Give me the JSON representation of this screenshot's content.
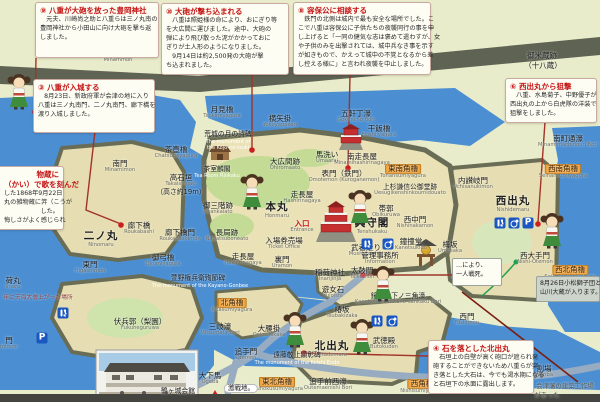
{
  "sign": {
    "background": "#e9ecca",
    "accent_red": "#c41414",
    "moat_blue": "#4b8fd2",
    "wall_olive": "#6a6d55"
  },
  "annotation_boxes": [
    {
      "title": "⑨ 八重が大砲を放った豊岡神社",
      "lines": [
        "　元夫、川崎尚之助と八重らは三ノ丸南の",
        "豊岡神社から小田山に向け大砲を撃ち返",
        "しました。"
      ],
      "x": 35,
      "y": 2,
      "w": 124,
      "h": 56
    },
    {
      "title": "⑩ 大砲が撃ち込まれる",
      "lines": [
        "　八重は照姫様の命により、おにぎり等",
        "を大広間に運びました。途中、大砲の",
        "弾により飛び散った泥がかかっておに",
        "ぎりが土人形のようになりました。",
        "　9月14日は約2,500発の大砲が撃",
        "ち込まれました。"
      ],
      "x": 161,
      "y": 3,
      "w": 128,
      "h": 61
    },
    {
      "title": "⑧ 容保公に相談する",
      "lines": [
        "　鉄門の北側は城内で最も安全な場所でした。こ",
        "こで八重は容保公に子供たちの夜襲同行の事を申",
        "し上げると「一同の健気な志は褒めて遣わすが、女",
        "や子供のみを出撃されては、城中兵なき事を示す",
        "が如きもので、かえって城中の不覚となるから差",
        "し控える様に」と言われ夜襲を中止しました。"
      ],
      "x": 293,
      "y": 2,
      "w": 138,
      "h": 73
    },
    {
      "title": "③ 八重が入城する",
      "lines": [
        "　8月23日、新政府軍が会津の地に入り",
        "八重は三ノ丸南門、二ノ丸南門、廊下橋を",
        "渡り入城しました。"
      ],
      "x": 33,
      "y": 79,
      "w": 122,
      "h": 54
    },
    {
      "title": "⑥ 西出丸から狙撃",
      "lines": [
        "　八重、水島菊子、中野優子が",
        "西出丸の上から白虎隊の洋装で",
        "狙撃をしました。"
      ],
      "x": 505,
      "y": 78,
      "w": 92,
      "h": 44
    },
    {
      "title": "④ 石を落とした北出丸",
      "lines": [
        "　石垣上の白壁が高く砲口が遮られ発",
        "砲することができないため八重らが突",
        "き落とした大石は、今でも渇水期になる",
        "と石垣下の水面に露出します。"
      ],
      "x": 428,
      "y": 340,
      "w": 106,
      "h": 53
    }
  ],
  "cut_box": {
    "title_lines": [
      "物蔵に",
      "（かい）で歌を刻んだ"
    ],
    "lines": [
      "した1868年9月22日",
      "丸の雑物蔵に笄（こうが",
      "した。",
      "悔しさがよく感じられ"
    ],
    "x": 0,
    "y": 166,
    "w": 64,
    "h": 64
  },
  "notes": [
    {
      "lines": [
        "8月26日小松獅子団と",
        "山川大蔵が入ります。"
      ],
      "x": 536,
      "y": 276,
      "w": 64,
      "h": 26,
      "bg": "#cdd4cb"
    },
    {
      "lines": [
        "…により、",
        "一人戦死。"
      ],
      "x": 452,
      "y": 258,
      "w": 50,
      "h": 28,
      "bg": "#fdfdf4"
    }
  ],
  "map": {
    "labels": [
      {
        "t": "南門",
        "r": "Minammon",
        "x": 118,
        "y": 50
      },
      {
        "t": "南門",
        "r": "Minamimon",
        "x": 120,
        "y": 160
      },
      {
        "t": "月見櫓",
        "r": "Tsukimiyagura",
        "x": 222,
        "y": 106
      },
      {
        "t": "横矢掛",
        "r": "Yokoyagakari",
        "x": 280,
        "y": 115
      },
      {
        "t": "五軒丁濠",
        "r": "Gokencho Bori",
        "x": 356,
        "y": 110
      },
      {
        "t": "干飯櫓",
        "r": "Hoshiiyagura",
        "x": 379,
        "y": 125
      },
      {
        "t": "茶壺櫓",
        "r": "Chatsubayagura",
        "x": 176,
        "y": 146
      },
      {
        "t": "高石垣",
        "r": "Takaishigaki",
        "x": 181,
        "y": 174
      },
      {
        "t": "（高さ約19m）",
        "x": 181,
        "y": 189,
        "s": "small"
      },
      {
        "t": "御米蔵跡",
        "x": 542,
        "y": 52
      },
      {
        "t": "（十八蔵）",
        "x": 543,
        "y": 62
      },
      {
        "t": "南町通濠",
        "r": "Minamimachidouri Bori",
        "x": 568,
        "y": 135
      },
      {
        "t": "西南角櫓",
        "r": "Seinansumiyagura",
        "x": 563,
        "y": 164,
        "s": "chip-orange"
      },
      {
        "t": "東南角櫓",
        "r": "Tonansumiyagura",
        "x": 403,
        "y": 164,
        "s": "chip-orange"
      },
      {
        "t": "内讃岐門",
        "r": "Uchisanukimon",
        "x": 473,
        "y": 177
      },
      {
        "t": "上杉謙信公御堂跡",
        "r": "Uesugikenshinkoumidouato",
        "x": 410,
        "y": 184,
        "s": "small"
      },
      {
        "t": "西出丸",
        "r": "Nishidemaru",
        "x": 513,
        "y": 196,
        "s": "bold"
      },
      {
        "t": "西中門",
        "r": "Nishinakamon",
        "x": 415,
        "y": 216
      },
      {
        "t": "梅坂",
        "r": "Umesaka",
        "x": 450,
        "y": 241
      },
      {
        "t": "鐘撞堂",
        "r": "Kanetsukido",
        "x": 411,
        "y": 238
      },
      {
        "t": "西大手門",
        "r": "Nishi-Otemon",
        "x": 535,
        "y": 252
      },
      {
        "t": "西北角櫓",
        "r": "Seihokusumiyagura",
        "x": 570,
        "y": 265,
        "s": "chip-orange"
      },
      {
        "t": "荒城の月の詩碑",
        "x": 228,
        "y": 131,
        "s": "small"
      },
      {
        "t": "The monument of",
        "x": 228,
        "y": 140,
        "s": "en-white"
      },
      {
        "t": "the Kojo-no-tsuki",
        "x": 228,
        "y": 146,
        "s": "en-white"
      },
      {
        "t": "茶室麟閣",
        "x": 217,
        "y": 166,
        "s": "small"
      },
      {
        "t": "Tea Room Rinkaku",
        "x": 217,
        "y": 174,
        "s": "en-white"
      },
      {
        "t": "大広間跡",
        "r": "Ohiromaato",
        "x": 285,
        "y": 158
      },
      {
        "t": "馬洗い",
        "r": "Umaarai",
        "x": 327,
        "y": 151
      },
      {
        "t": "南走長屋",
        "r": "Minamihashirinagaya",
        "x": 362,
        "y": 153
      },
      {
        "t": "表門（鉄門）",
        "r": "Omotemon (Kuroganemon)",
        "x": 344,
        "y": 170
      },
      {
        "t": "走長屋",
        "r": "Hashirinagaya",
        "x": 302,
        "y": 191
      },
      {
        "t": "本丸",
        "r": "Honmaru",
        "x": 277,
        "y": 202,
        "s": "bold"
      },
      {
        "t": "御三階跡",
        "r": "Osankaiato",
        "x": 218,
        "y": 202
      },
      {
        "t": "長局跡",
        "r": "Nagatsuboneato",
        "x": 227,
        "y": 229
      },
      {
        "t": "入口",
        "r": "Entrance",
        "x": 302,
        "y": 220,
        "s": "red"
      },
      {
        "t": "入場券売場",
        "r": "Ticket Office",
        "x": 284,
        "y": 237
      },
      {
        "t": "天守閣",
        "r": "Tenshukaku",
        "x": 372,
        "y": 218,
        "s": "bold"
      },
      {
        "t": "武者走り",
        "r": "Mushabashiri",
        "x": 366,
        "y": 244
      },
      {
        "t": "帯郭",
        "r": "Obikuruwa",
        "x": 386,
        "y": 205
      },
      {
        "t": "裏門",
        "r": "Uramon",
        "x": 282,
        "y": 256
      },
      {
        "t": "走長屋",
        "r": "Hashirinagaya",
        "x": 243,
        "y": 253
      },
      {
        "t": "管理事務所",
        "r": "Information",
        "x": 380,
        "y": 252
      },
      {
        "t": "萱野権兵衛殉節碑",
        "x": 198,
        "y": 275,
        "s": "small"
      },
      {
        "t": "The monument of the Kayano-Gonbee",
        "x": 200,
        "y": 284,
        "s": "en-white"
      },
      {
        "t": "稲荷神社",
        "r": "Inarijinja",
        "x": 330,
        "y": 269
      },
      {
        "t": "太鼓門",
        "r": "Taikomon",
        "x": 362,
        "y": 267
      },
      {
        "t": "遊女石",
        "r": "Yujoishi",
        "x": 333,
        "y": 286
      },
      {
        "t": "椿坂",
        "r": "Tsubakizaka",
        "x": 342,
        "y": 306
      },
      {
        "t": "鐘撞堂下ノ三角濠",
        "r": "Kanetsukidoshitano-sankaku Bori",
        "x": 398,
        "y": 293,
        "s": "small"
      },
      {
        "t": "北角櫓",
        "r": "Kitasumiyagura",
        "x": 232,
        "y": 298,
        "s": "chip-orange"
      },
      {
        "t": "三岐濠",
        "r": "Mitsumata Bori",
        "x": 220,
        "y": 323
      },
      {
        "t": "大腰掛",
        "r": "Ookoshikake",
        "x": 269,
        "y": 325
      },
      {
        "t": "北出丸",
        "r": "Kitademaru",
        "x": 332,
        "y": 341,
        "s": "bold"
      },
      {
        "t": "武徳殿",
        "r": "Butokuden",
        "x": 384,
        "y": 337
      },
      {
        "t": "遠藤敬止顕彰碑",
        "x": 297,
        "y": 352,
        "s": "small"
      },
      {
        "t": "The monument of the Keishi Endo",
        "x": 297,
        "y": 361,
        "s": "en-white"
      },
      {
        "t": "追手門",
        "r": "Otemon",
        "x": 246,
        "y": 348
      },
      {
        "t": "大下馬",
        "r": "Ogeba",
        "x": 210,
        "y": 372
      },
      {
        "t": "東北角櫓",
        "r": "Touhokusumiyagura",
        "x": 277,
        "y": 377,
        "s": "chip-orange"
      },
      {
        "t": "追手前西濠",
        "r": "Outemaenishi Bori",
        "x": 328,
        "y": 378
      },
      {
        "t": "西角櫓",
        "r": "Nishisumiyagura",
        "x": 422,
        "y": 379,
        "s": "chip-orange"
      },
      {
        "t": "西門",
        "r": "Nishimon",
        "x": 467,
        "y": 313
      },
      {
        "t": "割場",
        "r": "Wariba",
        "x": 544,
        "y": 365
      },
      {
        "t": "会津藩の建築工作場",
        "x": 565,
        "y": 383,
        "s": "gray"
      },
      {
        "t": "があった",
        "x": 547,
        "y": 392,
        "s": "gray"
      },
      {
        "t": "東門",
        "r": "Higashimon",
        "x": 90,
        "y": 261
      },
      {
        "t": "荷丸",
        "r": "imaru",
        "x": 13,
        "y": 277
      },
      {
        "t": "年に天海大僧上がった場所",
        "x": 38,
        "y": 295,
        "s": "tiny"
      },
      {
        "t": "伏兵郭（梨園）",
        "r": "Fukuheguruwa",
        "x": 140,
        "y": 318
      },
      {
        "t": "二ノ丸",
        "r": "Ninomaru",
        "x": 101,
        "y": 231,
        "s": "bold"
      },
      {
        "t": "廊下橋",
        "r": "Roukabashi",
        "x": 139,
        "y": 222
      },
      {
        "t": "廊下橋門",
        "r": "Roukabashimon",
        "x": 180,
        "y": 229
      },
      {
        "t": "御弓櫓",
        "r": "Oyumiyagura",
        "x": 163,
        "y": 254
      },
      {
        "t": "鶴ヶ城会館",
        "x": 178,
        "y": 388,
        "s": "small"
      },
      {
        "t": "激戦地。",
        "x": 241,
        "y": 384,
        "s": "chip-white"
      },
      {
        "t": "門",
        "r": "mimon",
        "x": 9,
        "y": 337
      }
    ],
    "facility_icons": [
      {
        "type": "toilet",
        "x": 500,
        "y": 223
      },
      {
        "type": "wheel",
        "x": 514,
        "y": 223
      },
      {
        "type": "park",
        "glyph": "P",
        "x": 528,
        "y": 223
      },
      {
        "type": "toilet",
        "x": 367,
        "y": 244
      },
      {
        "type": "wheel",
        "x": 388,
        "y": 244
      },
      {
        "type": "toilet",
        "x": 377,
        "y": 321
      },
      {
        "type": "wheel",
        "x": 392,
        "y": 321
      },
      {
        "type": "toilet",
        "x": 63,
        "y": 313
      },
      {
        "type": "park",
        "glyph": "P",
        "x": 42,
        "y": 338
      }
    ],
    "characters": [
      {
        "x": 19,
        "y": 92
      },
      {
        "x": 252,
        "y": 192
      },
      {
        "x": 360,
        "y": 208
      },
      {
        "x": 552,
        "y": 231
      },
      {
        "x": 295,
        "y": 330
      },
      {
        "x": 362,
        "y": 337
      },
      {
        "x": 383,
        "y": 284
      }
    ]
  }
}
